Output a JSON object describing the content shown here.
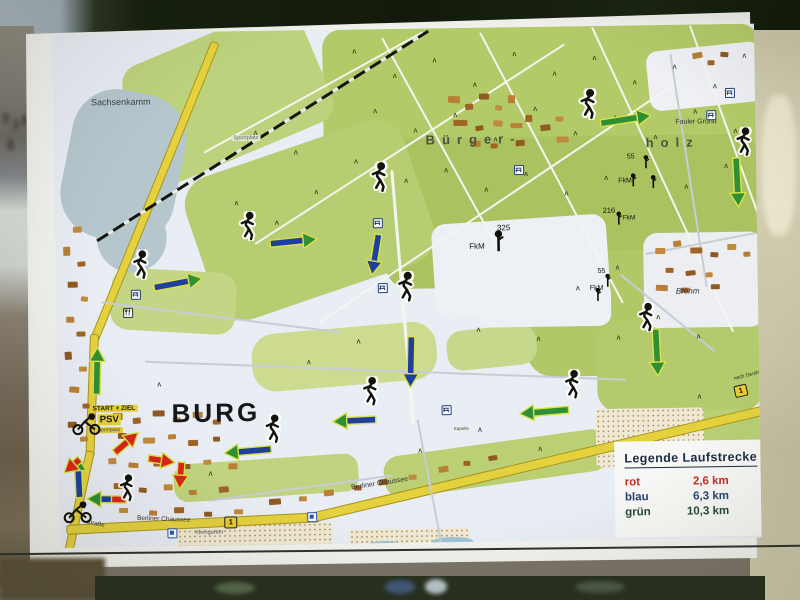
{
  "scene": {
    "description": "photo of an outdoor route-map sign board",
    "board_color": "#f2f2ee"
  },
  "legend": {
    "title": "Legende Laufstrecke",
    "items": [
      {
        "label": "rot",
        "value": "2,6 km",
        "color": "#c22f24"
      },
      {
        "label": "blau",
        "value": "6,3 km",
        "color": "#2c3f72"
      },
      {
        "label": "grün",
        "value": "10,3 km",
        "color": "#27483a"
      }
    ]
  },
  "map": {
    "route_colors": {
      "green": "#2e8f35",
      "blue": "#1e3f9e",
      "red": "#d82618",
      "outline": "#d9e24a"
    },
    "areas": [
      [
        270,
        0,
        436,
        170,
        "#b2ca68",
        18,
        0
      ],
      [
        330,
        110,
        376,
        150,
        "#aac360",
        24,
        0
      ],
      [
        140,
        115,
        230,
        150,
        "#b6cd72",
        30,
        -18
      ],
      [
        80,
        0,
        190,
        125,
        "#bdd27c",
        20,
        -22
      ],
      [
        470,
        225,
        236,
        125,
        "#b0c866",
        26,
        0
      ],
      [
        540,
        295,
        166,
        92,
        "#b4cb6d",
        22,
        0
      ],
      [
        635,
        320,
        70,
        45,
        "#b4cb6d",
        18,
        0
      ],
      [
        598,
        385,
        108,
        70,
        "#b9cf74",
        16,
        0
      ],
      [
        55,
        238,
        125,
        62,
        "#c4d586",
        18,
        4
      ],
      [
        195,
        298,
        185,
        58,
        "#ccdb90",
        24,
        -4
      ],
      [
        115,
        428,
        185,
        38,
        "#c0d37e",
        14,
        -3
      ],
      [
        325,
        415,
        225,
        42,
        "#bbd074",
        16,
        -7
      ],
      [
        390,
        300,
        90,
        40,
        "#c6d88c",
        16,
        -5
      ],
      [
        12,
        58,
        115,
        150,
        "#b5c6cd",
        45,
        12
      ],
      [
        40,
        150,
        70,
        90,
        "#b5c6cd",
        40,
        -10
      ],
      [
        378,
        192,
        175,
        95,
        "#edf0f5",
        14,
        -3
      ],
      [
        425,
        255,
        130,
        45,
        "#edf0f5",
        12,
        0
      ],
      [
        595,
        22,
        115,
        60,
        "#eef0f4",
        12,
        -5
      ],
      [
        588,
        208,
        120,
        95,
        "#eceef2",
        14,
        0
      ]
    ],
    "stipples": [
      [
        538,
        383,
        108,
        58
      ],
      [
        118,
        492,
        155,
        26
      ],
      [
        290,
        500,
        120,
        18
      ]
    ],
    "ponds": [
      [
        308,
        512,
        34,
        9
      ],
      [
        372,
        509,
        42,
        11
      ]
    ],
    "roads": [
      [
        163,
        8,
        320,
        113,
        7,
        "y"
      ],
      [
        38,
        298,
        122,
        93,
        7,
        "y"
      ],
      [
        32,
        415,
        135,
        103,
        7,
        "y"
      ],
      [
        8,
        492,
        252,
        -2,
        8,
        "y"
      ],
      [
        255,
        483,
        462,
        -12.5,
        8,
        "y"
      ],
      [
        200,
        212,
        368,
        -32,
        2,
        "w"
      ],
      [
        262,
        292,
        430,
        -33,
        2,
        "w"
      ],
      [
        330,
        8,
        236,
        62,
        2,
        "w"
      ],
      [
        428,
        4,
        306,
        63,
        2,
        "w"
      ],
      [
        540,
        0,
        336,
        66,
        2,
        "w"
      ],
      [
        638,
        0,
        266,
        71,
        2,
        "w"
      ],
      [
        150,
        120,
        250,
        -28,
        2,
        "w"
      ],
      [
        338,
        140,
        255,
        86,
        2.5,
        "w"
      ],
      [
        45,
        268,
        242,
        8,
        1.5,
        "g"
      ],
      [
        88,
        328,
        482,
        3,
        1.5,
        "g"
      ],
      [
        360,
        390,
        130,
        80,
        1.5,
        "g"
      ],
      [
        565,
        248,
        122,
        40,
        1.5,
        "g"
      ],
      [
        590,
        228,
        112,
        -10,
        1.5,
        "g"
      ],
      [
        618,
        28,
        236,
        82,
        2,
        "g"
      ],
      [
        150,
        468,
        185,
        -7,
        1.5,
        "g"
      ]
    ],
    "railway": [
      42,
      206,
      392,
      -31.5
    ],
    "buildings": [
      [
        395,
        68,
        12,
        7,
        5
      ],
      [
        412,
        76,
        8,
        6,
        -5
      ],
      [
        426,
        66,
        10,
        6,
        0
      ],
      [
        442,
        78,
        7,
        5,
        10
      ],
      [
        455,
        68,
        7,
        8,
        0
      ],
      [
        400,
        92,
        14,
        6,
        0
      ],
      [
        422,
        98,
        8,
        5,
        -8
      ],
      [
        440,
        93,
        9,
        6,
        4
      ],
      [
        457,
        96,
        12,
        5,
        0
      ],
      [
        472,
        88,
        7,
        7,
        0
      ],
      [
        487,
        98,
        10,
        6,
        -5
      ],
      [
        502,
        90,
        8,
        5,
        0
      ],
      [
        417,
        113,
        10,
        6,
        3
      ],
      [
        437,
        116,
        7,
        5,
        0
      ],
      [
        462,
        113,
        9,
        6,
        -4
      ],
      [
        503,
        110,
        12,
        6,
        0
      ],
      [
        640,
        28,
        10,
        6,
        -10
      ],
      [
        655,
        36,
        7,
        5,
        0
      ],
      [
        668,
        28,
        8,
        5,
        5
      ],
      [
        600,
        223,
        10,
        6,
        0
      ],
      [
        618,
        216,
        8,
        6,
        -8
      ],
      [
        635,
        223,
        12,
        6,
        0
      ],
      [
        655,
        228,
        8,
        5,
        5
      ],
      [
        672,
        220,
        9,
        6,
        0
      ],
      [
        688,
        228,
        7,
        5,
        0
      ],
      [
        610,
        243,
        8,
        5,
        0
      ],
      [
        630,
        246,
        10,
        5,
        -5
      ],
      [
        650,
        248,
        7,
        5,
        0
      ],
      [
        600,
        260,
        12,
        6,
        3
      ],
      [
        625,
        263,
        8,
        5,
        0
      ],
      [
        655,
        260,
        9,
        5,
        0
      ],
      [
        18,
        193,
        9,
        6,
        0
      ],
      [
        8,
        213,
        7,
        9,
        0
      ],
      [
        22,
        228,
        8,
        5,
        -5
      ],
      [
        12,
        248,
        10,
        6,
        0
      ],
      [
        25,
        263,
        7,
        5,
        8
      ],
      [
        10,
        283,
        8,
        6,
        0
      ],
      [
        20,
        298,
        9,
        5,
        0
      ],
      [
        8,
        318,
        7,
        8,
        -4
      ],
      [
        22,
        333,
        8,
        5,
        0
      ],
      [
        12,
        353,
        10,
        6,
        5
      ],
      [
        25,
        370,
        7,
        5,
        0
      ],
      [
        10,
        388,
        9,
        6,
        0
      ],
      [
        22,
        403,
        8,
        5,
        -6
      ],
      [
        55,
        380,
        10,
        7,
        0
      ],
      [
        75,
        385,
        8,
        6,
        -5
      ],
      [
        95,
        378,
        12,
        6,
        0
      ],
      [
        115,
        385,
        8,
        5,
        6
      ],
      [
        135,
        380,
        10,
        6,
        0
      ],
      [
        155,
        388,
        8,
        5,
        0
      ],
      [
        60,
        400,
        9,
        6,
        4
      ],
      [
        85,
        405,
        12,
        6,
        0
      ],
      [
        110,
        402,
        8,
        5,
        -5
      ],
      [
        130,
        408,
        10,
        6,
        0
      ],
      [
        155,
        405,
        7,
        5,
        0
      ],
      [
        50,
        425,
        8,
        6,
        0
      ],
      [
        70,
        430,
        10,
        5,
        5
      ],
      [
        95,
        428,
        8,
        6,
        0
      ],
      [
        120,
        432,
        12,
        5,
        0
      ],
      [
        145,
        428,
        8,
        5,
        -4
      ],
      [
        170,
        432,
        9,
        6,
        0
      ],
      [
        55,
        450,
        10,
        6,
        0
      ],
      [
        80,
        455,
        8,
        5,
        6
      ],
      [
        105,
        452,
        9,
        6,
        0
      ],
      [
        130,
        458,
        8,
        5,
        0
      ],
      [
        160,
        455,
        10,
        6,
        -5
      ],
      [
        210,
        468,
        12,
        6,
        -3
      ],
      [
        240,
        466,
        8,
        5,
        0
      ],
      [
        265,
        460,
        10,
        6,
        -5
      ],
      [
        295,
        456,
        8,
        5,
        0
      ],
      [
        320,
        450,
        9,
        6,
        -6
      ],
      [
        350,
        446,
        8,
        5,
        0
      ],
      [
        380,
        438,
        10,
        6,
        -8
      ],
      [
        405,
        433,
        7,
        5,
        0
      ],
      [
        430,
        428,
        9,
        5,
        -8
      ],
      [
        60,
        475,
        9,
        5,
        0
      ],
      [
        90,
        478,
        8,
        5,
        4
      ],
      [
        115,
        475,
        10,
        6,
        0
      ],
      [
        145,
        480,
        8,
        5,
        0
      ],
      [
        175,
        478,
        9,
        5,
        0
      ]
    ],
    "trees": [
      [
        300,
        20
      ],
      [
        340,
        45
      ],
      [
        380,
        30
      ],
      [
        420,
        55
      ],
      [
        460,
        25
      ],
      [
        500,
        45
      ],
      [
        540,
        30
      ],
      [
        580,
        55
      ],
      [
        620,
        40
      ],
      [
        660,
        60
      ],
      [
        690,
        30
      ],
      [
        320,
        80
      ],
      [
        360,
        100
      ],
      [
        400,
        85
      ],
      [
        440,
        110
      ],
      [
        480,
        80
      ],
      [
        520,
        105
      ],
      [
        560,
        90
      ],
      [
        600,
        110
      ],
      [
        640,
        85
      ],
      [
        680,
        105
      ],
      [
        300,
        130
      ],
      [
        350,
        150
      ],
      [
        390,
        140
      ],
      [
        430,
        160
      ],
      [
        470,
        145
      ],
      [
        510,
        165
      ],
      [
        550,
        150
      ],
      [
        630,
        160
      ],
      [
        670,
        140
      ],
      [
        240,
        120
      ],
      [
        200,
        100
      ],
      [
        260,
        160
      ],
      [
        220,
        190
      ],
      [
        180,
        170
      ],
      [
        560,
        240
      ],
      [
        600,
        290
      ],
      [
        640,
        310
      ],
      [
        560,
        310
      ],
      [
        520,
        260
      ],
      [
        480,
        310
      ],
      [
        420,
        300
      ],
      [
        250,
        330
      ],
      [
        300,
        310
      ],
      [
        360,
        420
      ],
      [
        420,
        400
      ],
      [
        480,
        420
      ],
      [
        640,
        370
      ],
      [
        660,
        430
      ],
      [
        150,
        440
      ],
      [
        100,
        350
      ]
    ],
    "labels": [
      {
        "t": "Sachsenkamm",
        "x": 38,
        "y": 64,
        "s": 9,
        "c": "#3c4042"
      },
      {
        "t": "Bürger-",
        "x": 372,
        "y": 104,
        "s": 13,
        "c": "#4a5240",
        "ls": 7,
        "w": 600
      },
      {
        "t": "holz",
        "x": 592,
        "y": 110,
        "s": 13,
        "c": "#4a5240",
        "ls": 7,
        "w": 600
      },
      {
        "t": "Fauler Grund",
        "x": 622,
        "y": 94,
        "s": 7,
        "c": "#333333"
      },
      {
        "t": "BURG",
        "x": 114,
        "y": 366,
        "s": 26,
        "c": "#15171a",
        "w": 700,
        "ls": 3
      },
      {
        "t": "START + ZIEL",
        "x": 33,
        "y": 372,
        "s": 6.5,
        "c": "#222222",
        "w": 700,
        "bg": "#e6cf3a"
      },
      {
        "t": "PSV",
        "x": 40,
        "y": 381,
        "s": 9.5,
        "c": "#1a1a1a",
        "w": 700,
        "bg": "#e6cf3a"
      },
      {
        "t": "Sportplatz",
        "x": 38,
        "y": 394,
        "s": 5,
        "c": "#444444",
        "bg": "#e6cf3a"
      },
      {
        "t": "Sportplatz",
        "x": 178,
        "y": 104,
        "s": 5.5,
        "c": "#666677",
        "bg": "#dfe6c8"
      },
      {
        "t": "Brehm",
        "x": 620,
        "y": 262,
        "s": 8,
        "c": "#2e2e2e",
        "i": 1
      },
      {
        "t": "Berliner Chaussee",
        "x": 292,
        "y": 455,
        "s": 7,
        "c": "#333333",
        "r": -8
      },
      {
        "t": "Berliner Chaussee",
        "x": 78,
        "y": 482,
        "s": 6.5,
        "c": "#333333",
        "r": 3
      },
      {
        "t": "Straße",
        "x": 28,
        "y": 486,
        "s": 6,
        "c": "#333333",
        "r": 12
      },
      {
        "t": "nach Genthin",
        "x": 676,
        "y": 352,
        "s": 5,
        "c": "#222222",
        "r": -13
      },
      {
        "t": "Kleingarten",
        "x": 136,
        "y": 498,
        "s": 5.5,
        "c": "#555555"
      },
      {
        "t": "Kapelle",
        "x": 396,
        "y": 398,
        "s": 4.5,
        "c": "#554422"
      },
      {
        "t": "325",
        "x": 442,
        "y": 196,
        "s": 8,
        "c": "#111111"
      },
      {
        "t": "FkM",
        "x": 414,
        "y": 214,
        "s": 8,
        "c": "#111111"
      },
      {
        "t": "216",
        "x": 548,
        "y": 180,
        "s": 7.5,
        "c": "#111111"
      },
      {
        "t": "FkM",
        "x": 568,
        "y": 189,
        "s": 6.5,
        "c": "#111111"
      },
      {
        "t": "55",
        "x": 573,
        "y": 128,
        "s": 7,
        "c": "#111111"
      },
      {
        "t": "FkM",
        "x": 564,
        "y": 152,
        "s": 7,
        "c": "#111111"
      },
      {
        "t": "55",
        "x": 542,
        "y": 242,
        "s": 7,
        "c": "#111111"
      },
      {
        "t": "FkM",
        "x": 534,
        "y": 259,
        "s": 7,
        "c": "#111111"
      }
    ],
    "shields": [
      {
        "t": "1",
        "x": 165,
        "y": 485,
        "r": 0
      },
      {
        "t": "1",
        "x": 677,
        "y": 361,
        "r": -12
      }
    ],
    "arrows": [
      [
        122,
        251,
        48,
        -10,
        "bg"
      ],
      [
        238,
        211,
        46,
        -5,
        "bg"
      ],
      [
        572,
        94,
        50,
        -8,
        "g"
      ],
      [
        683,
        158,
        48,
        88,
        "g"
      ],
      [
        320,
        225,
        40,
        100,
        "b"
      ],
      [
        354,
        333,
        50,
        92,
        "b"
      ],
      [
        600,
        327,
        46,
        88,
        "g"
      ],
      [
        487,
        385,
        48,
        176,
        "g"
      ],
      [
        297,
        391,
        42,
        178,
        "bg"
      ],
      [
        190,
        420,
        46,
        176,
        "bg"
      ],
      [
        40,
        338,
        46,
        -88,
        "g"
      ],
      [
        20,
        444,
        40,
        -92,
        "bg"
      ],
      [
        68,
        410,
        30,
        -40,
        "r"
      ],
      [
        103,
        428,
        26,
        10,
        "r"
      ],
      [
        122,
        443,
        26,
        95,
        "r"
      ],
      [
        48,
        466,
        38,
        182,
        "m"
      ],
      [
        14,
        432,
        20,
        140,
        "r"
      ]
    ],
    "runners": [
      [
        85,
        232,
        1
      ],
      [
        193,
        195,
        1
      ],
      [
        325,
        148,
        1.05
      ],
      [
        350,
        258,
        1.05
      ],
      [
        535,
        78,
        1.05
      ],
      [
        690,
        118,
        1
      ],
      [
        590,
        292,
        1
      ],
      [
        515,
        358,
        1
      ],
      [
        313,
        362,
        1
      ],
      [
        215,
        398,
        1
      ],
      [
        68,
        455,
        0.95
      ]
    ],
    "cyclists": [
      [
        12,
        380
      ],
      [
        2,
        468
      ]
    ],
    "picnics": [
      [
        318,
        189
      ],
      [
        322,
        254
      ],
      [
        460,
        138
      ],
      [
        672,
        64
      ],
      [
        653,
        86
      ],
      [
        384,
        377
      ],
      [
        75,
        257
      ]
    ],
    "restaurant": [
      [
        67,
        275
      ]
    ],
    "poi_blue": [
      [
        108,
        496
      ],
      [
        248,
        482
      ]
    ],
    "monuments": [
      [
        437,
        203,
        1.6
      ],
      [
        588,
        130,
        1
      ],
      [
        575,
        148,
        1
      ],
      [
        595,
        150,
        1
      ],
      [
        560,
        186,
        1
      ],
      [
        548,
        248,
        1
      ],
      [
        538,
        262,
        1
      ]
    ]
  }
}
